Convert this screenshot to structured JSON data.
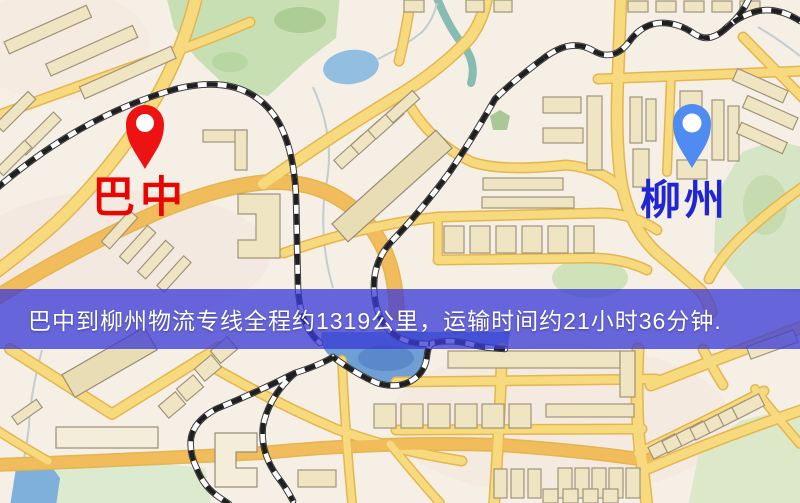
{
  "map": {
    "origin_label": "巴中",
    "destination_label": "柳州",
    "origin_marker_color": "#ee1313",
    "destination_marker_color": "#4f8cf2",
    "origin_label_color": "#e90500",
    "destination_label_color": "#2126d4",
    "road_color": "#f8da7e",
    "park_color": "#cfe2ba",
    "water_color": "#6f9fd4"
  },
  "banner": {
    "text": "巴中到柳州物流专线全程约1319公里，运输时间约21小时36分钟.",
    "background_color": "#3a3ad6",
    "text_color": "#ffffff"
  }
}
